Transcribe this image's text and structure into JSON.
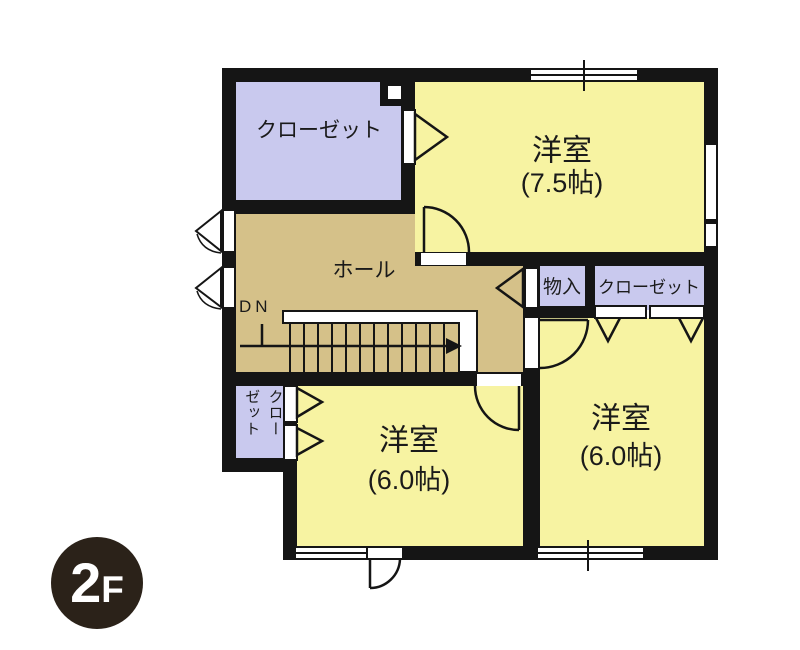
{
  "plan": {
    "floor_badge": {
      "main": "2",
      "suffix": "F"
    },
    "rooms": {
      "closet_top_left": {
        "label": "クローゼット"
      },
      "western_room_1": {
        "label": "洋室",
        "area": "(7.5帖)"
      },
      "hall": {
        "label": "ホール",
        "stairs_direction": "DN"
      },
      "storage": {
        "label": "物入"
      },
      "closet_right": {
        "label": "クローゼット"
      },
      "closet_small": {
        "label": "クローゼット",
        "line1": "クロー",
        "line2": "ゼット"
      },
      "western_room_2": {
        "label": "洋室",
        "area": "(6.0帖)"
      },
      "western_room_3": {
        "label": "洋室",
        "area": "(6.0帖)"
      }
    },
    "colors": {
      "wall": "#151515",
      "room_yellow": "#f7f3a2",
      "closet_lavender": "#c9c9ee",
      "hall_tan": "#d5c189",
      "badge": "#2b2219",
      "paper": "#ffffff",
      "text": "#1a1a1a"
    }
  }
}
